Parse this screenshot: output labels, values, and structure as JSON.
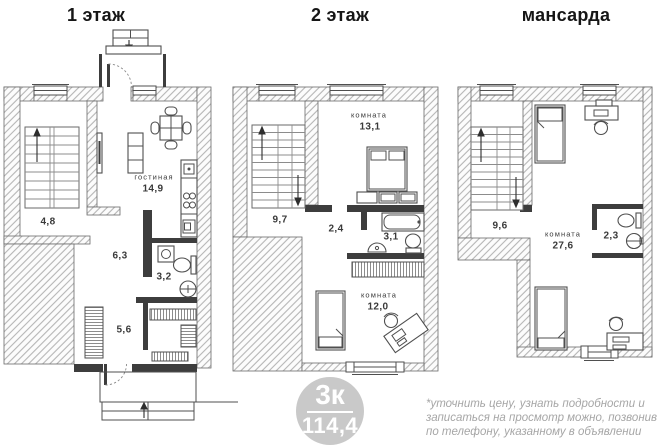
{
  "titles": {
    "floor1": "1 этаж",
    "floor2": "2 этаж",
    "attic": "мансарда"
  },
  "floor1": {
    "rooms": {
      "stair_hall": {
        "area": "4,8"
      },
      "living": {
        "name": "гостиная",
        "area": "14,9"
      },
      "hall": {
        "area": "6,3"
      },
      "bathroom": {
        "area": "3,2"
      },
      "dressing": {
        "area": "5,6"
      }
    }
  },
  "floor2": {
    "rooms": {
      "stair_hall": {
        "area": "9,7"
      },
      "bedroom": {
        "name": "комната",
        "area": "13,1"
      },
      "hall": {
        "area": "2,4"
      },
      "bathroom": {
        "area": "3,1"
      },
      "room": {
        "name": "комната",
        "area": "12,0"
      }
    }
  },
  "attic": {
    "rooms": {
      "stair_hall": {
        "area": "9,6"
      },
      "room": {
        "name": "комната",
        "area": "27,6"
      },
      "bathroom": {
        "area": "2,3"
      }
    }
  },
  "badge": {
    "label": "3к",
    "total_area": "114,4",
    "bg_color": "#c9c9c9",
    "text_color": "#ffffff"
  },
  "disclaimer": {
    "lines": [
      "*уточнить цену, узнать подробности и",
      "записаться на просмотр можно, позвонив",
      "по телефону, указанному в объявлении"
    ]
  }
}
